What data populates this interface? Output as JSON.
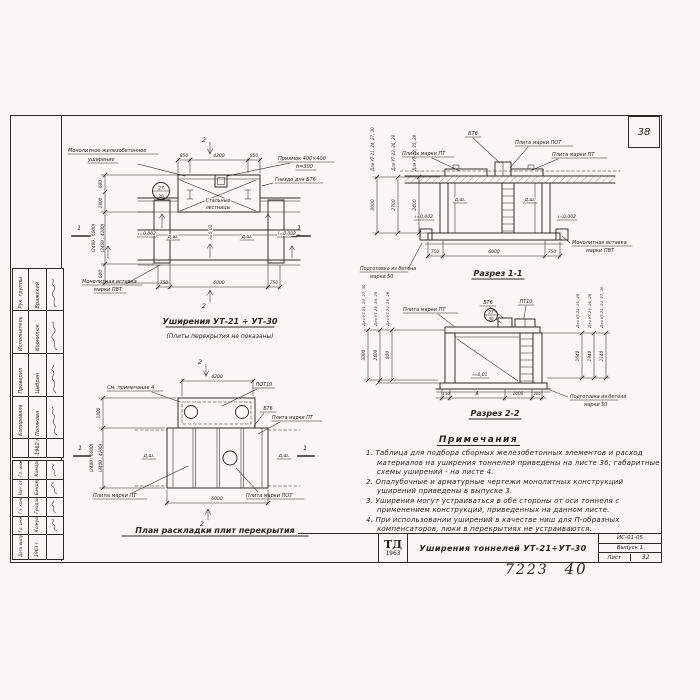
{
  "sheet": {
    "corner_number": "38",
    "doc_number": "7223",
    "page_number": "40"
  },
  "titleblock": {
    "logo_top": "ТД",
    "logo_year": "1963",
    "title": "Уширения тоннелей УТ-21÷УТ-30",
    "code": "ИС-01-05",
    "issue": "Выпуск 1",
    "sheet_label": "Лист",
    "sheet_number": "32"
  },
  "stamp": {
    "group1": {
      "rows": [
        {
          "role": "Рук. группы",
          "name": "Вражский"
        },
        {
          "role": "Исполнитель",
          "name": "Корнилюк"
        },
        {
          "role": "Проверил",
          "name": "Цыбрин"
        },
        {
          "role": "Копировала",
          "name": "Полякова"
        }
      ],
      "date": "1962 г."
    },
    "group2": {
      "date_label": "Дата выпуска",
      "date": "1963 г.",
      "rows": [
        {
          "role": "Гл. инженер",
          "name": "Комаровский"
        },
        {
          "role": "Нач. отдела",
          "name": "Бандер"
        },
        {
          "role": "Гл. конструктор",
          "name": "Гродзинский"
        },
        {
          "role": "Гл. инж. пр.",
          "name": "Кожушкевич"
        }
      ]
    }
  },
  "plan_top": {
    "title": "Уширения УТ-21 ÷ УТ-30",
    "subtitle": "(Плиты перекрытия не показаны)",
    "labels": {
      "widening": [
        "Монолитное железобетонное",
        "уширение"
      ],
      "pit": [
        "Приямок 400×400",
        "h=300"
      ],
      "socket": "Гнездо для БТ6",
      "stairs": [
        "Стальные",
        "лестницы"
      ],
      "insert": [
        "Монолитная вставка",
        "марки ПВТ"
      ],
      "joint": "д.ш.",
      "slope_side": "i=0,002",
      "slope_main": "i=0,01",
      "ref": [
        "27",
        "30"
      ]
    },
    "dims": {
      "top": [
        "850",
        "4200",
        "850"
      ],
      "bottom": [
        "750",
        "6000",
        "750"
      ],
      "left": [
        "600",
        "1800",
        "(2400 ; 6000)",
        "(3400 ; 4200)",
        "600"
      ]
    },
    "marker_sec2": "2",
    "marker_sec1": "1"
  },
  "section1": {
    "title": "Разрез 1-1",
    "labels": {
      "bt6": "БТ6",
      "pot": "Плита марки ПОТ",
      "pt_many": "Плиты марки ПТ",
      "pt": "Плита марки ПТ",
      "joint": "д.ш.",
      "slope": "i=0,002",
      "base": [
        "Подготовка из бетона",
        "марки 50"
      ],
      "insert": [
        "Монолитная вставка",
        "марки ПВТ"
      ]
    },
    "dims": {
      "bottom": [
        "750",
        "6000",
        "750"
      ],
      "heights": [
        {
          "tunnels": "Для УТ-21, 24, 27, 30",
          "value": "3000"
        },
        {
          "tunnels": "Для УТ-23, 26, 29",
          "value": "2700"
        },
        {
          "tunnels": "Для УТ-22, 25, 28",
          "value": "2400"
        }
      ]
    }
  },
  "section2": {
    "title": "Разрез 2-2",
    "labels": {
      "pt": "Плита марки ПТ",
      "bt6": "БТ6",
      "pt10": "ПТ10",
      "slope": "i=0,01",
      "base": [
        "Подготовка из бетона",
        "марки 50"
      ],
      "ref": [
        "27",
        "30"
      ]
    },
    "dims": {
      "bottom": [
        "150",
        "А",
        "1000",
        "300"
      ],
      "left": [
        {
          "tunnels": "Для УТ-21, 24, 27, 30",
          "value": "3000"
        },
        {
          "tunnels": "Для УТ-23, 26, 29",
          "value": "2400"
        },
        {
          "tunnels": "Для УТ-22, 25, 28",
          "value": "800"
        }
      ],
      "right": [
        {
          "tunnels": "Для УТ-22, 25, 28",
          "value": "1640"
        },
        {
          "tunnels": "Для УТ-23, 26, 29",
          "value": "1940"
        },
        {
          "tunnels": "Для УТ-21, 24, 27, 30",
          "value": "2140"
        }
      ]
    }
  },
  "plan_bottom": {
    "title": "План раскладки плит перекрытия",
    "labels": {
      "see_note": "См. примечание 4",
      "pot10": "ПОТ10",
      "bt6": "БТ6",
      "pt": "Плита марки ПТ",
      "pt_many": "Плиты марки ПТ",
      "pot": "Плита марки ПОТ",
      "joint": "д.ш."
    },
    "dims": {
      "top": "4200",
      "bottom": "6000",
      "left": [
        "1800",
        "(2400 ; 6000)",
        "(3400 ; 4200)"
      ]
    },
    "marker_sec2": "2",
    "marker_sec1": "1"
  },
  "notes": {
    "title": "Примечания",
    "items": [
      "1. Таблица для подбора сборных железобетонных элементов и расход материалов на уширения тоннелей приведены на листе 36; габаритные схемы уширений - на листе 4.",
      "2. Опалубочные и арматурные чертежи монолитных конструкций уширений приведены в выпуске 3.",
      "3. Уширения могут устраиваться в обе стороны от оси тоннеля с применением конструкций, приведенных на данном листе.",
      "4. При использовании уширений в качестве ниш для П-образных компенсаторов, люки в перекрытиях не устраиваются."
    ]
  },
  "colors": {
    "ink": "#2b2923",
    "paper": "#f8f7f3"
  }
}
